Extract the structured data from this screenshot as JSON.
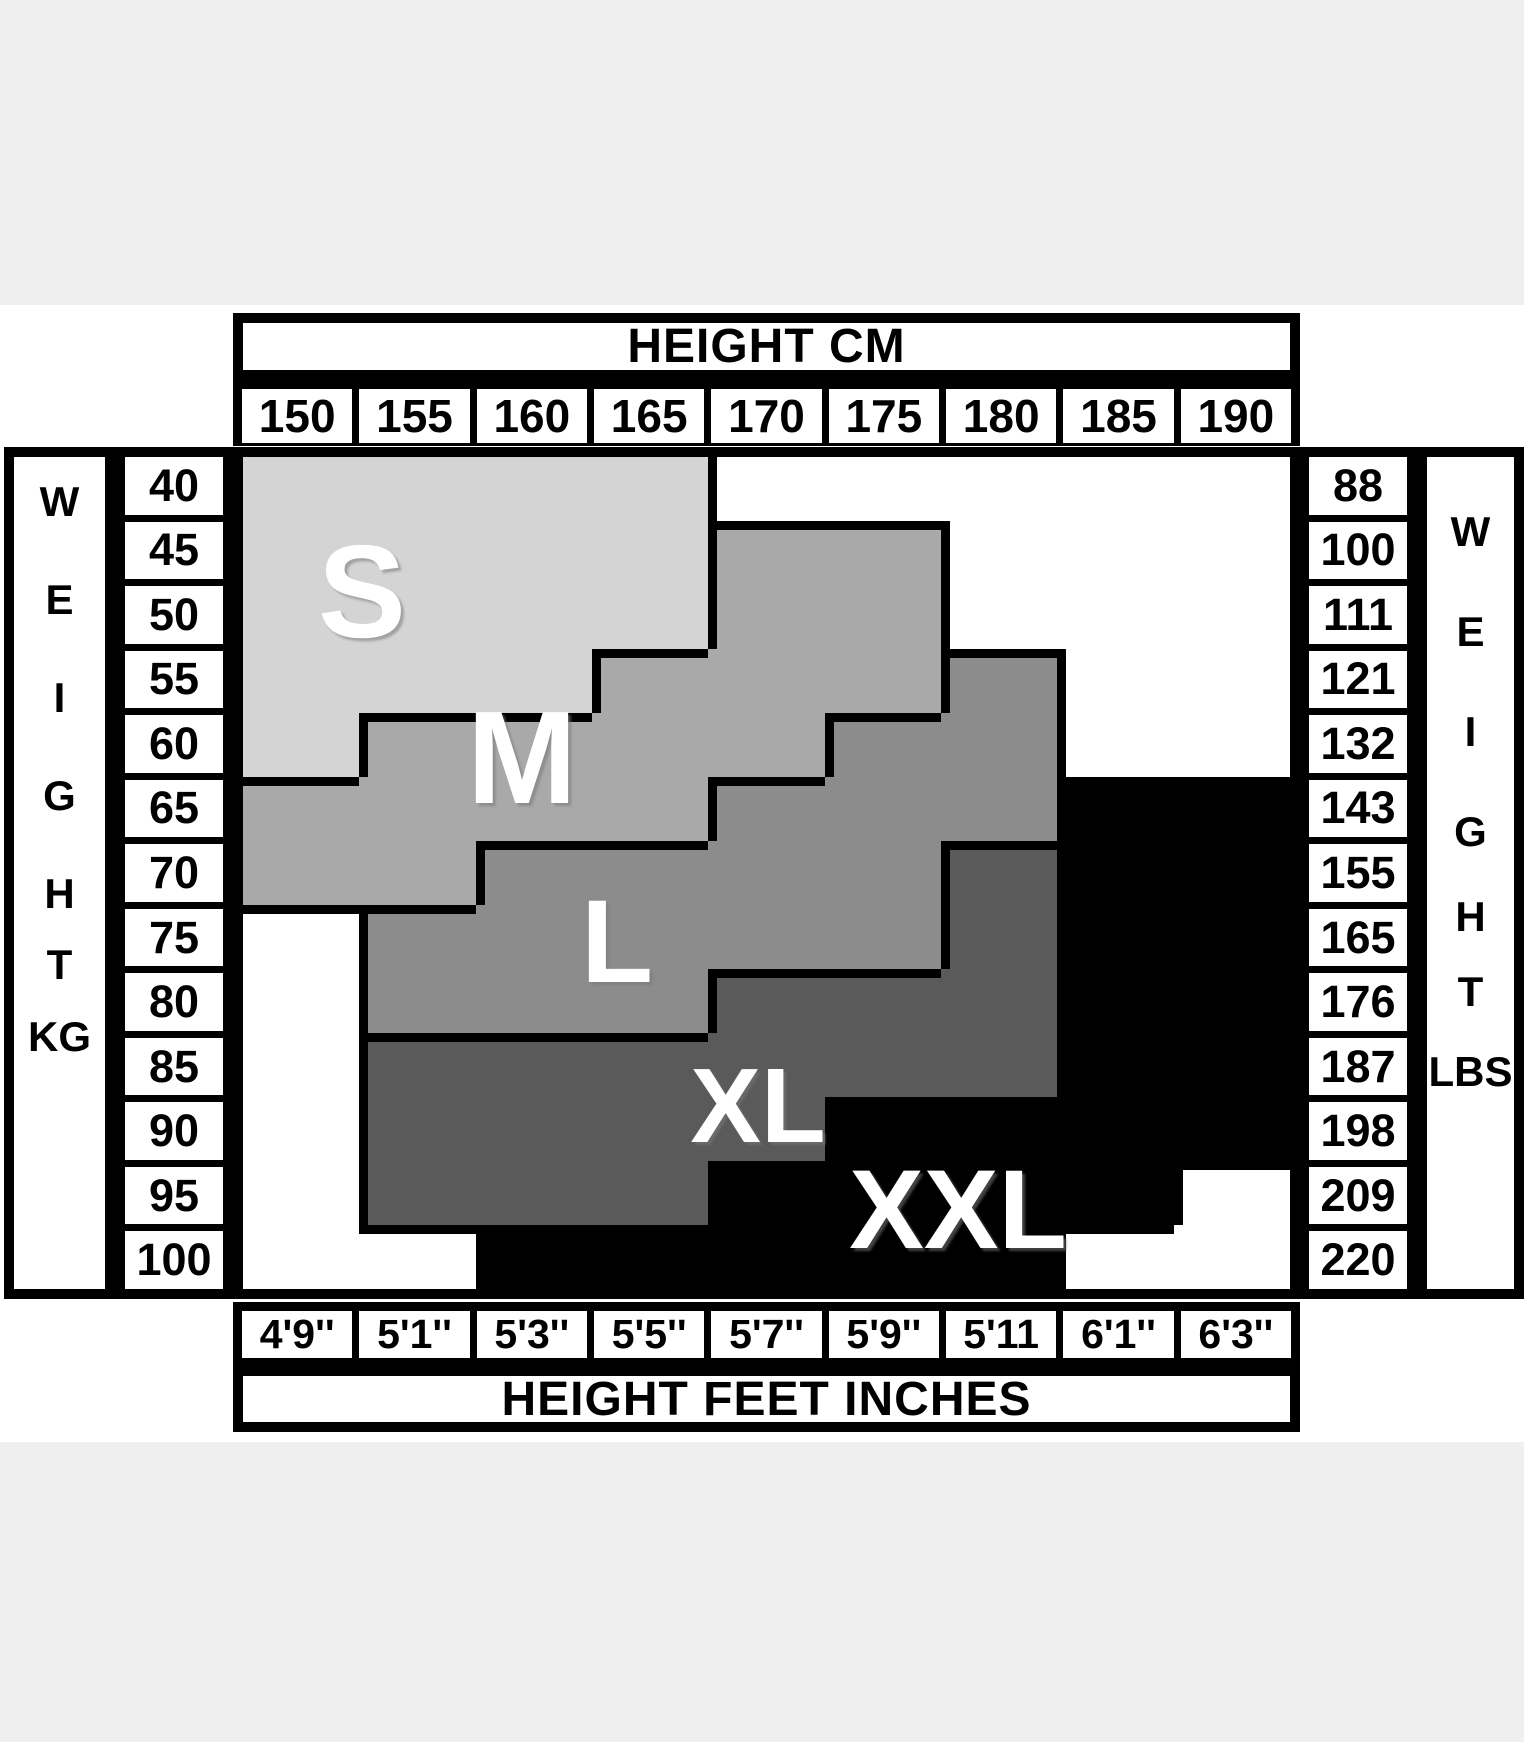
{
  "titles": {
    "top": "HEIGHT CM",
    "bottom": "HEIGHT FEET INCHES"
  },
  "left_axis": {
    "letters": [
      "W",
      "E",
      "I",
      "G",
      "H",
      "T"
    ],
    "unit": "KG"
  },
  "right_axis": {
    "letters": [
      "W",
      "E",
      "I",
      "G",
      "H",
      "T"
    ],
    "unit": "LBS"
  },
  "chart_data": {
    "type": "heatmap",
    "title": "HEIGHT CM",
    "xlabel_bottom": "HEIGHT FEET INCHES",
    "columns_cm": [
      "150",
      "155",
      "160",
      "165",
      "170",
      "175",
      "180",
      "185",
      "190"
    ],
    "columns_ft": [
      "4'9''",
      "5'1''",
      "5'3''",
      "5'5''",
      "5'7''",
      "5'9''",
      "5'11",
      "6'1''",
      "6'3''"
    ],
    "rows_kg": [
      "40",
      "45",
      "50",
      "55",
      "60",
      "65",
      "70",
      "75",
      "80",
      "85",
      "90",
      "95",
      "100"
    ],
    "rows_lbs": [
      "88",
      "100",
      "111",
      "121",
      "132",
      "143",
      "155",
      "165",
      "176",
      "187",
      "198",
      "209",
      "220"
    ],
    "sizes": [
      "S",
      "M",
      "L",
      "XL",
      "XXL"
    ],
    "size_colors": {
      "S": "#d4d4d4",
      "M": "#a9a9a9",
      "L": "#8c8c8c",
      "X": "#5a5a5a",
      "K": "#000000",
      "W": "#ffffff"
    },
    "grid": [
      "SSSSWWWWW",
      "SSSSMMWWW",
      "SSSSMMWWW",
      "SSSMMMLWW",
      "SMMMMLLWW",
      "MMMMLLLKK",
      "MMLLLLXKK",
      "WLLLLLXKK",
      "WLLLXXXKK",
      "WXXXXXXKK",
      "WXXXXKKKK",
      "WXXXKKKKW",
      "WWKKKKKWW"
    ],
    "annotations": [
      {
        "text": "S",
        "x": 352,
        "y": 582,
        "size": 132
      },
      {
        "text": "M",
        "x": 512,
        "y": 748,
        "size": 132
      },
      {
        "text": "L",
        "x": 607,
        "y": 932,
        "size": 118
      },
      {
        "text": "XL",
        "x": 748,
        "y": 1096,
        "size": 106
      },
      {
        "text": "XXL",
        "x": 948,
        "y": 1200,
        "size": 112
      }
    ]
  },
  "letter_positions": {
    "left": [
      45,
      143,
      241,
      339,
      437,
      508
    ],
    "left_unit_y": 580,
    "right": [
      75,
      175,
      275,
      375,
      460,
      535
    ],
    "right_unit_y": 615
  }
}
